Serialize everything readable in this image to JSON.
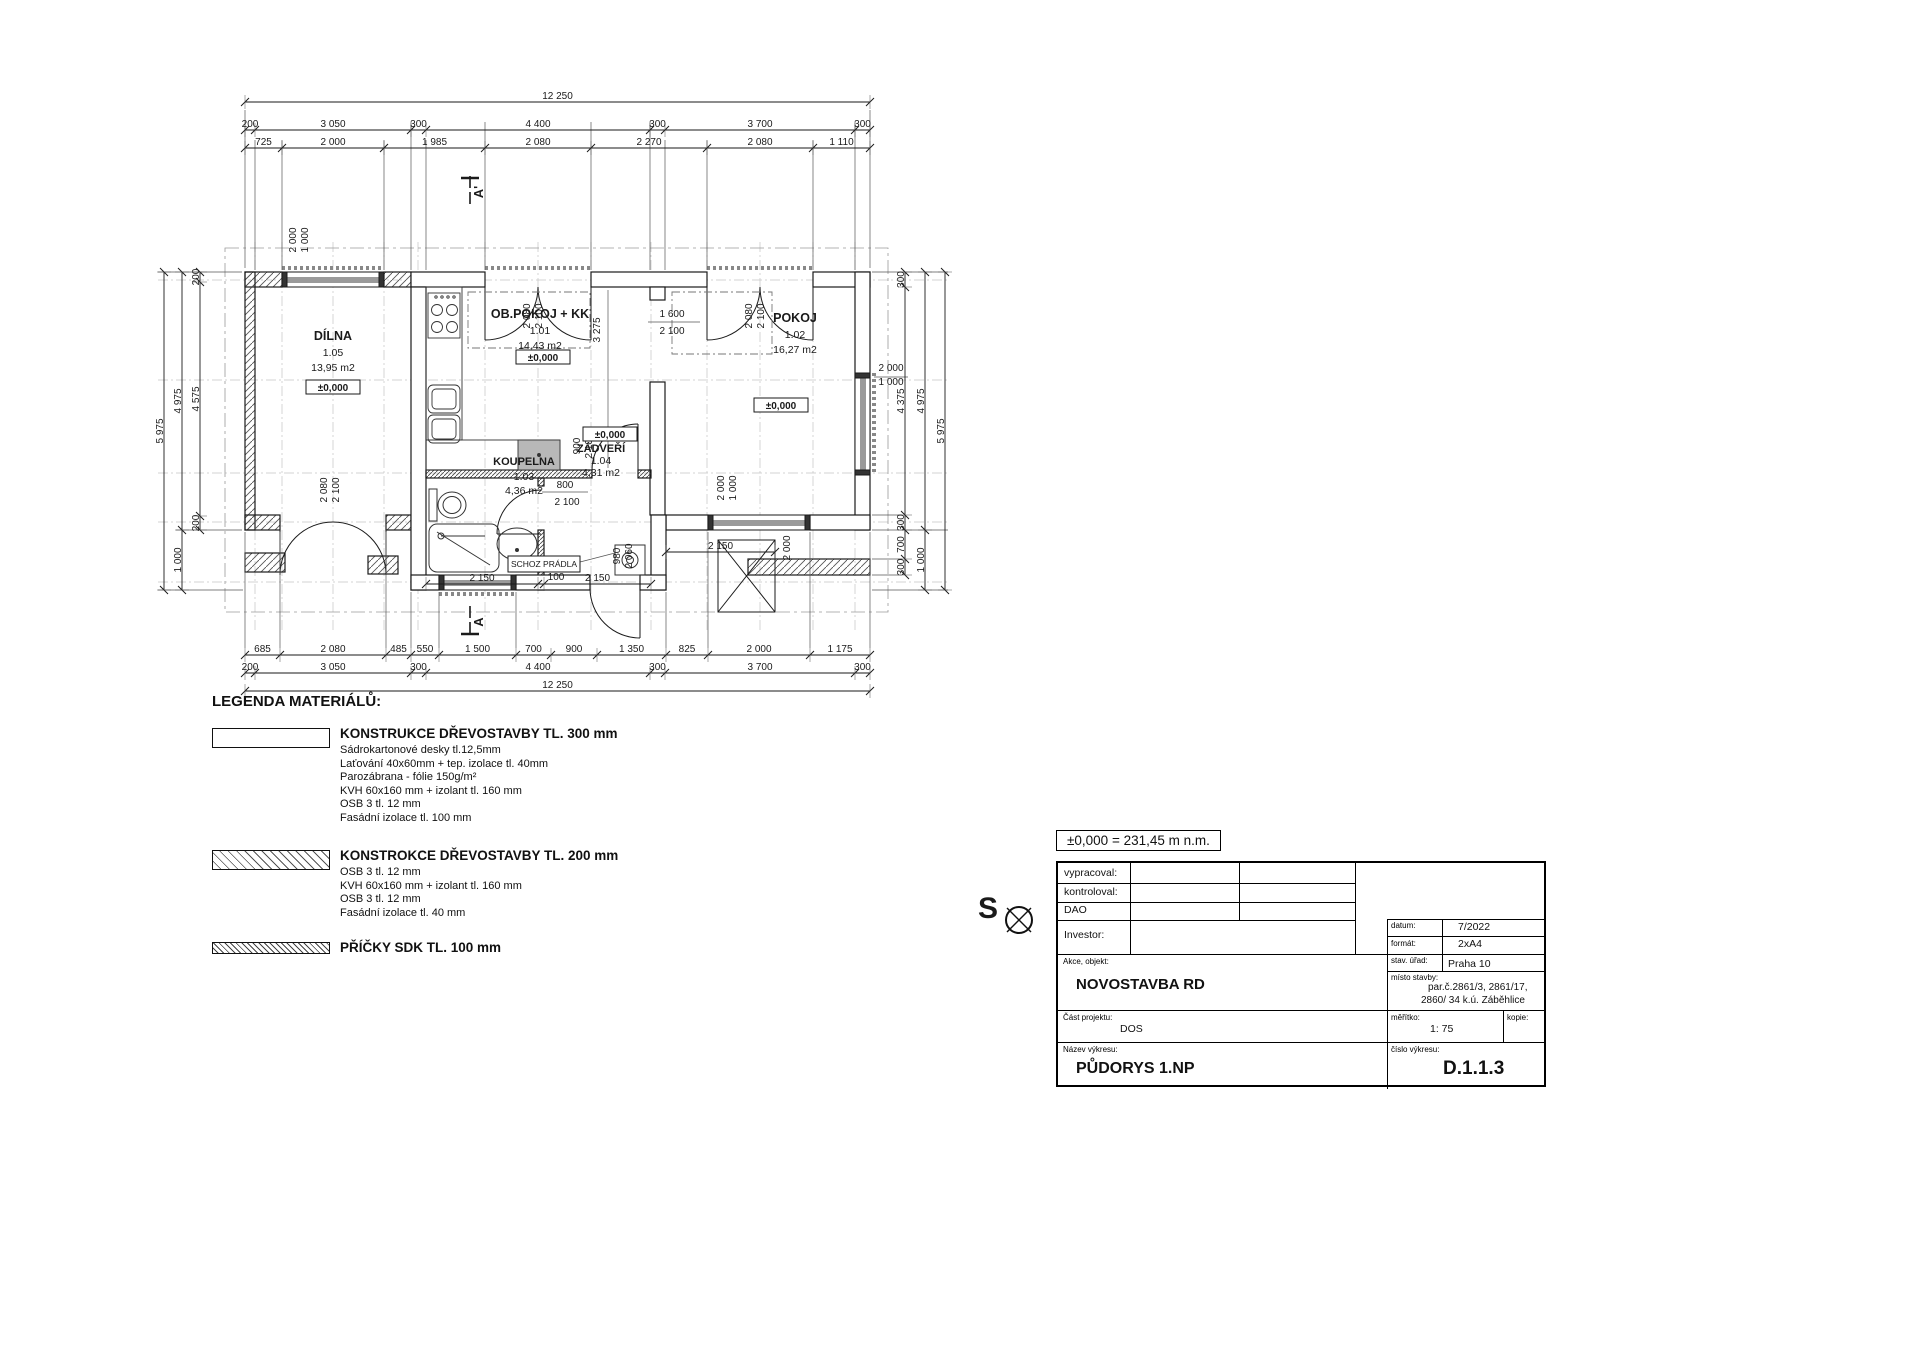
{
  "plan": {
    "rooms": [
      {
        "name": "DÍLNA",
        "number": "1.05",
        "area": "13,95 m2"
      },
      {
        "name": "OB.POKOJ + KK",
        "number": "1.01",
        "area": "14,43 m2"
      },
      {
        "name": "POKOJ",
        "number": "1.02",
        "area": "16,27 m2"
      },
      {
        "name": "KOUPELNA",
        "number": "1.03",
        "area": "4,36 m2"
      },
      {
        "name": "ZÁDVEŘÍ",
        "number": "1.04",
        "area": "4,31 m2"
      }
    ],
    "level_label": "±0,000",
    "laundry_label": "SCHOZ PRÁDLA",
    "grid": {
      "vx": [
        255,
        282,
        333,
        384,
        418,
        485,
        538,
        591,
        651,
        707,
        760,
        813,
        855
      ],
      "vy1": 242,
      "vy2": 630,
      "hy": [
        280,
        380,
        473,
        522,
        582
      ],
      "hx1": 158,
      "hx2": 950
    },
    "dim_rows": [
      {
        "o": "h",
        "pos": 102,
        "breaks": [
          245,
          870
        ],
        "labels": [
          "12 250"
        ]
      },
      {
        "o": "h",
        "pos": 130,
        "breaks": [
          245,
          255,
          411,
          426,
          650,
          665,
          855,
          870
        ],
        "labels": [
          "200",
          "3 050",
          "300",
          "4 400",
          "300",
          "3 700",
          "300"
        ]
      },
      {
        "o": "h",
        "pos": 148,
        "breaks": [
          245,
          282,
          384,
          485,
          591,
          707,
          813,
          870
        ],
        "labels": [
          "725",
          "2 000",
          "1 985",
          "2 080",
          "2 270",
          "2 080",
          "1 110"
        ]
      },
      {
        "o": "h",
        "pos": 655,
        "breaks": [
          245,
          280,
          386,
          411,
          439,
          516,
          551,
          597,
          666,
          708,
          810,
          870
        ],
        "labels": [
          "685",
          "2 080",
          "485",
          "550",
          "1 500",
          "700",
          "900",
          "1 350",
          "825",
          "2 000",
          "1 175"
        ]
      },
      {
        "o": "h",
        "pos": 673,
        "breaks": [
          245,
          255,
          411,
          426,
          650,
          665,
          855,
          870
        ],
        "labels": [
          "200",
          "3 050",
          "300",
          "4 400",
          "300",
          "3 700",
          "300"
        ]
      },
      {
        "o": "h",
        "pos": 691,
        "breaks": [
          245,
          870
        ],
        "labels": [
          "12 250"
        ]
      },
      {
        "o": "v",
        "pos": 200,
        "breaks": [
          272,
          282,
          516,
          530
        ],
        "labels": [
          "200",
          "4 575",
          "200"
        ]
      },
      {
        "o": "v",
        "pos": 182,
        "breaks": [
          272,
          530,
          590
        ],
        "labels": [
          "4 975",
          "1 000"
        ]
      },
      {
        "o": "v",
        "pos": 164,
        "breaks": [
          272,
          590
        ],
        "labels": [
          "5 975"
        ]
      },
      {
        "o": "v",
        "pos": 905,
        "breaks": [
          272,
          287,
          515,
          530,
          559,
          575
        ],
        "labels": [
          "300",
          "4 375",
          "300",
          "700",
          "300"
        ]
      },
      {
        "o": "v",
        "pos": 925,
        "breaks": [
          272,
          530,
          590
        ],
        "labels": [
          "4 975",
          "1 000"
        ]
      },
      {
        "o": "v",
        "pos": 945,
        "breaks": [
          272,
          590
        ],
        "labels": [
          "5 975"
        ]
      },
      {
        "o": "h",
        "pos": 584,
        "breaks": [
          426,
          538,
          544,
          651
        ],
        "labels": [
          "2 150",
          "",
          "2 150"
        ]
      },
      {
        "o": "h",
        "pos": 552,
        "breaks": [
          666,
          775
        ],
        "labels": [
          "2 150"
        ]
      }
    ],
    "dim_labels": [
      {
        "t": "2 000",
        "x": 296,
        "y": 240,
        "r": -90
      },
      {
        "t": "1 000",
        "x": 308,
        "y": 240,
        "r": -90
      },
      {
        "t": "2 080",
        "x": 530,
        "y": 316,
        "r": -90
      },
      {
        "t": "2 100",
        "x": 542,
        "y": 316,
        "r": -90
      },
      {
        "t": "2 080",
        "x": 752,
        "y": 316,
        "r": -90
      },
      {
        "t": "2 100",
        "x": 764,
        "y": 316,
        "r": -90
      },
      {
        "t": "1 600",
        "x": 672,
        "y": 317,
        "r": 0
      },
      {
        "t": "2 100",
        "x": 672,
        "y": 334,
        "r": 0
      },
      {
        "t": "3 275",
        "x": 600,
        "y": 330,
        "r": -90
      },
      {
        "t": "900",
        "x": 580,
        "y": 446,
        "r": -90
      },
      {
        "t": "2 100",
        "x": 592,
        "y": 446,
        "r": -90
      },
      {
        "t": "800",
        "x": 565,
        "y": 488,
        "r": 0
      },
      {
        "t": "2 100",
        "x": 567,
        "y": 505,
        "r": 0
      },
      {
        "t": "100",
        "x": 556,
        "y": 580,
        "r": 0
      },
      {
        "t": "980",
        "x": 620,
        "y": 556,
        "r": -90
      },
      {
        "t": "2 060",
        "x": 632,
        "y": 556,
        "r": -90
      },
      {
        "t": "2 000",
        "x": 790,
        "y": 548,
        "r": -90
      },
      {
        "t": "2 000",
        "x": 724,
        "y": 488,
        "r": -90
      },
      {
        "t": "1 000",
        "x": 736,
        "y": 488,
        "r": -90
      },
      {
        "t": "2 000",
        "x": 891,
        "y": 371,
        "r": 0
      },
      {
        "t": "1 000",
        "x": 891,
        "y": 385,
        "r": 0
      },
      {
        "t": "2 080",
        "x": 327,
        "y": 490,
        "r": -90
      },
      {
        "t": "2 100",
        "x": 339,
        "y": 490,
        "r": -90
      },
      {
        "t": "A'",
        "x": 483,
        "y": 192,
        "r": -90,
        "fs": 13,
        "b": 1
      },
      {
        "t": "A",
        "x": 483,
        "y": 622,
        "r": -90,
        "fs": 13,
        "b": 1
      }
    ]
  },
  "legend": {
    "title": "LEGENDA MATERIÁLŮ:",
    "items": [
      {
        "title": "KONSTRUKCE DŘEVOSTAVBY TL. 300 mm",
        "lines": [
          "Sádrokartonové  desky tl.12,5mm",
          "Laťování 40x60mm + tep. izolace tl. 40mm",
          "Parozábrana - fólie 150g/m²",
          "KVH 60x160 mm + izolant tl. 160 mm",
          "OSB 3 tl. 12 mm",
          "Fasádní izolace tl. 100 mm"
        ]
      },
      {
        "title": "KONSTROKCE DŘEVOSTAVBY TL. 200 mm",
        "lines": [
          "OSB 3 tl. 12 mm",
          "KVH 60x160 mm + izolant tl. 160 mm",
          "OSB 3 tl. 12 mm",
          "Fasádní izolace tl. 40 mm"
        ]
      },
      {
        "title": "PŘÍČKY SDK TL. 100 mm",
        "lines": []
      }
    ]
  },
  "north_label": "S",
  "elevation_note": "±0,000 = 231,45 m n.m.",
  "titleblock": {
    "vypracoval": "vypracoval:",
    "kontroloval": "kontroloval:",
    "dao": "DAO",
    "investor": "Investor:",
    "datum_label": "datum:",
    "datum": "7/2022",
    "format_label": "formát:",
    "format": "2xA4",
    "urad_label": "stav. úřad:",
    "urad": "Praha 10",
    "akce_label": "Akce, objekt:",
    "akce": "NOVOSTAVBA RD",
    "misto_label": "místo stavby:",
    "misto1": "par.č.2861/3, 2861/17,",
    "misto2": "2860/ 34 k.ú. Záběhlice",
    "cast_label": "Část projektu:",
    "cast": "DOS",
    "meritko_label": "měřítko:",
    "meritko": "1: 75",
    "kopie_label": "kopie:",
    "nazev_label": "Název výkresu:",
    "nazev": "PŮDORYS 1.NP",
    "cislo_label": "číslo výkresu:",
    "cislo": "D.1.1.3"
  }
}
